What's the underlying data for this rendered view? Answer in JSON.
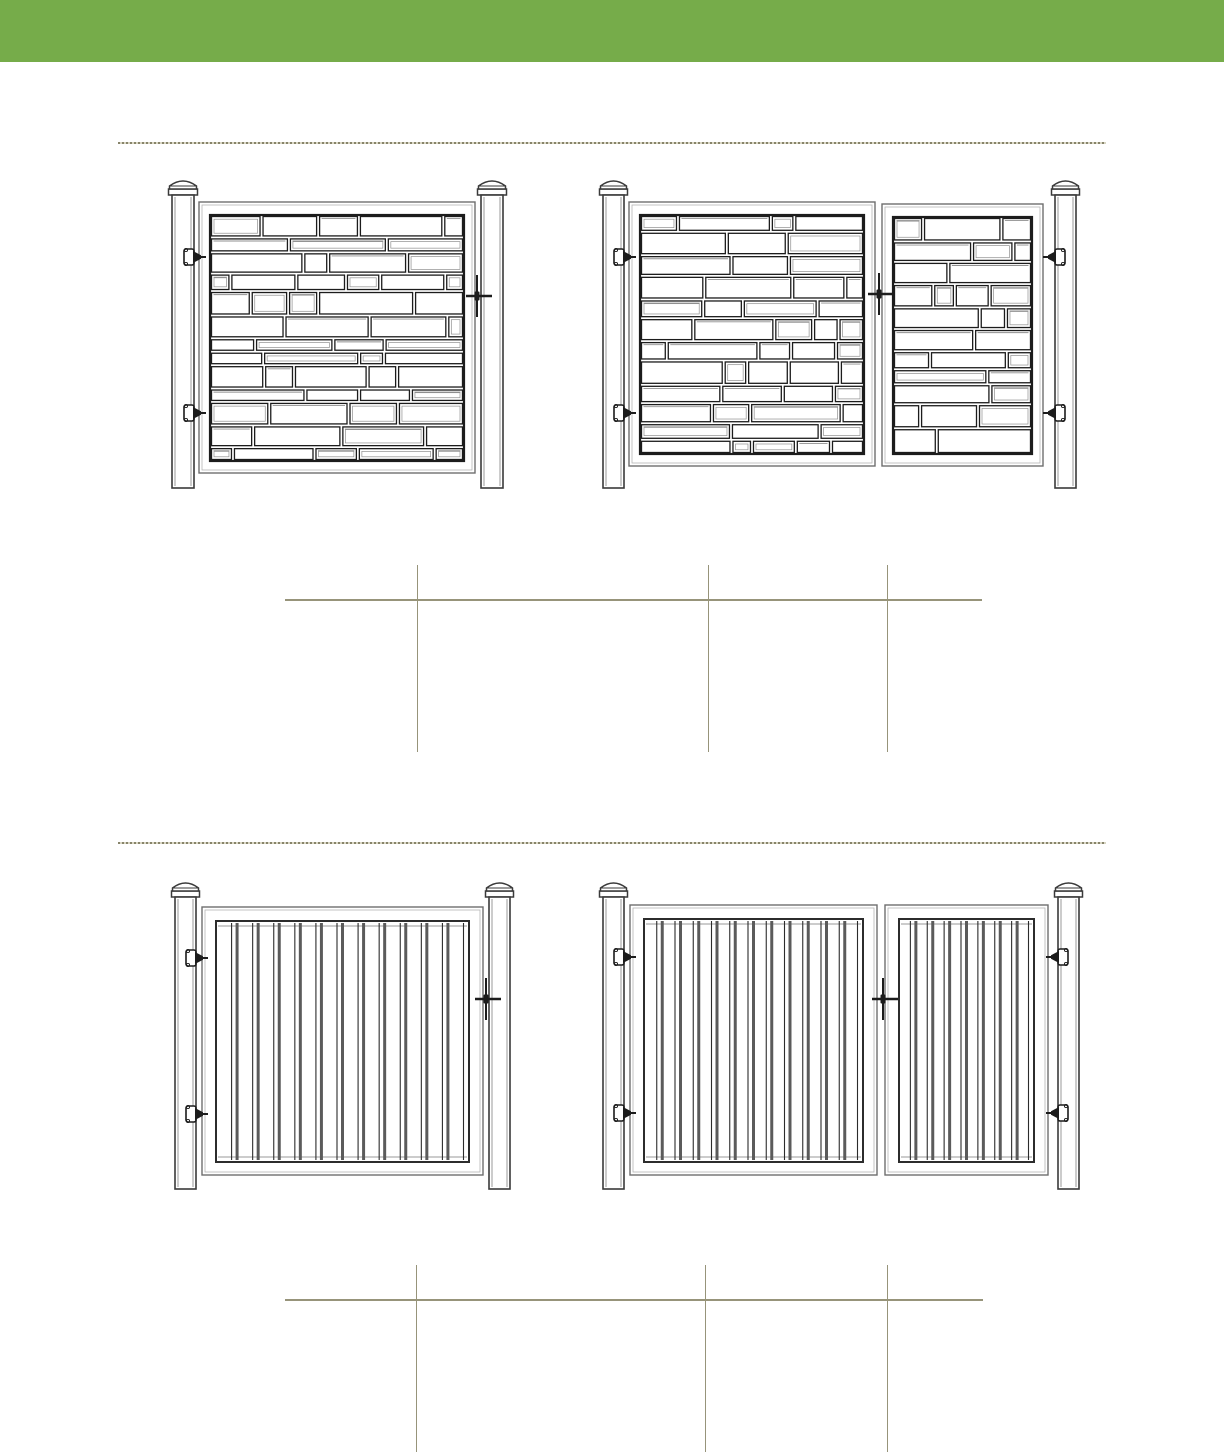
{
  "canvas": {
    "width": 1224,
    "height": 1454,
    "background": "#ffffff"
  },
  "header_bar": {
    "name": "header-green-bar",
    "color": "#76ac4a",
    "height": 62
  },
  "palette": {
    "rule_olive": "#97947a",
    "rule_dash_dark": "#87846a",
    "rule_dash_light": "#d9d6c3",
    "ink": "#1c1c1c",
    "frame_gray": "#6e6e6e",
    "frame_inner_gray": "#b5b5b5",
    "slat_bar_gray": "#5b5b5b",
    "slat_line_dark": "#2c2c2c",
    "post_stroke": "#3a3a3a",
    "post_shade": "#9a9a9a",
    "stone_shadow": "#8f8f8f",
    "white": "#ffffff"
  },
  "dividers": [
    {
      "name": "section-divider-1",
      "y": 143,
      "x1": 118,
      "x2": 1106
    },
    {
      "name": "section-divider-2",
      "y": 843,
      "x1": 118,
      "x2": 1106
    }
  ],
  "figures": [
    {
      "name": "stone-single-gate-drawing",
      "style": "stone",
      "posts": [
        {
          "x": 172,
          "y": 195,
          "w": 22,
          "h": 293
        },
        {
          "x": 481,
          "y": 195,
          "w": 22,
          "h": 293
        }
      ],
      "gates": [
        {
          "x": 199,
          "y": 202,
          "w": 276,
          "h": 271,
          "seed": 3
        }
      ],
      "hinges": [
        {
          "post": 0,
          "cy": 257,
          "dir": 1
        },
        {
          "post": 0,
          "cy": 413,
          "dir": 1
        }
      ],
      "latch": {
        "x": 477,
        "cy": 296
      }
    },
    {
      "name": "stone-double-gate-drawing",
      "style": "stone",
      "posts": [
        {
          "x": 603,
          "y": 195,
          "w": 21,
          "h": 293
        },
        {
          "x": 1055,
          "y": 195,
          "w": 21,
          "h": 293
        }
      ],
      "gates": [
        {
          "x": 629,
          "y": 202,
          "w": 246,
          "h": 264,
          "seed": 5
        },
        {
          "x": 882,
          "y": 204,
          "w": 161,
          "h": 262,
          "seed": 9
        }
      ],
      "hinges": [
        {
          "post": 0,
          "cy": 257,
          "dir": 1
        },
        {
          "post": 0,
          "cy": 413,
          "dir": 1
        },
        {
          "post": 1,
          "cy": 257,
          "dir": -1
        },
        {
          "post": 1,
          "cy": 413,
          "dir": -1
        }
      ],
      "latch": {
        "x": 879,
        "cy": 294
      }
    },
    {
      "name": "privacy-single-gate-drawing",
      "style": "slats",
      "posts": [
        {
          "x": 175,
          "y": 897,
          "w": 21,
          "h": 292
        },
        {
          "x": 489,
          "y": 897,
          "w": 21,
          "h": 292
        }
      ],
      "gates": [
        {
          "x": 202,
          "y": 907,
          "w": 281,
          "h": 268,
          "slats": 12
        }
      ],
      "hinges": [
        {
          "post": 0,
          "cy": 958,
          "dir": 1
        },
        {
          "post": 0,
          "cy": 1114,
          "dir": 1
        }
      ],
      "latch": {
        "x": 486,
        "cy": 999
      }
    },
    {
      "name": "privacy-double-gate-drawing",
      "style": "slats",
      "posts": [
        {
          "x": 603,
          "y": 897,
          "w": 21,
          "h": 292
        },
        {
          "x": 1058,
          "y": 897,
          "w": 21,
          "h": 292
        }
      ],
      "gates": [
        {
          "x": 630,
          "y": 905,
          "w": 247,
          "h": 270,
          "slats": 12
        },
        {
          "x": 885,
          "y": 905,
          "w": 163,
          "h": 270,
          "slats": 8
        }
      ],
      "hinges": [
        {
          "post": 0,
          "cy": 957,
          "dir": 1
        },
        {
          "post": 0,
          "cy": 1113,
          "dir": 1
        },
        {
          "post": 1,
          "cy": 957,
          "dir": -1
        },
        {
          "post": 1,
          "cy": 1113,
          "dir": -1
        }
      ],
      "latch": {
        "x": 883,
        "cy": 999
      }
    }
  ],
  "tables": [
    {
      "name": "spec-table-1",
      "hline": {
        "y": 600,
        "x1": 285,
        "x2": 982
      },
      "vlines": [
        {
          "x": 417,
          "y1": 565,
          "y2": 752
        },
        {
          "x": 708,
          "y1": 565,
          "y2": 752
        },
        {
          "x": 887,
          "y1": 565,
          "y2": 752
        }
      ]
    },
    {
      "name": "spec-table-2",
      "hline": {
        "y": 1300,
        "x1": 285,
        "x2": 983
      },
      "vlines": [
        {
          "x": 416,
          "y1": 1265,
          "y2": 1452
        },
        {
          "x": 705,
          "y1": 1265,
          "y2": 1452
        },
        {
          "x": 887,
          "y1": 1265,
          "y2": 1452
        }
      ]
    }
  ]
}
